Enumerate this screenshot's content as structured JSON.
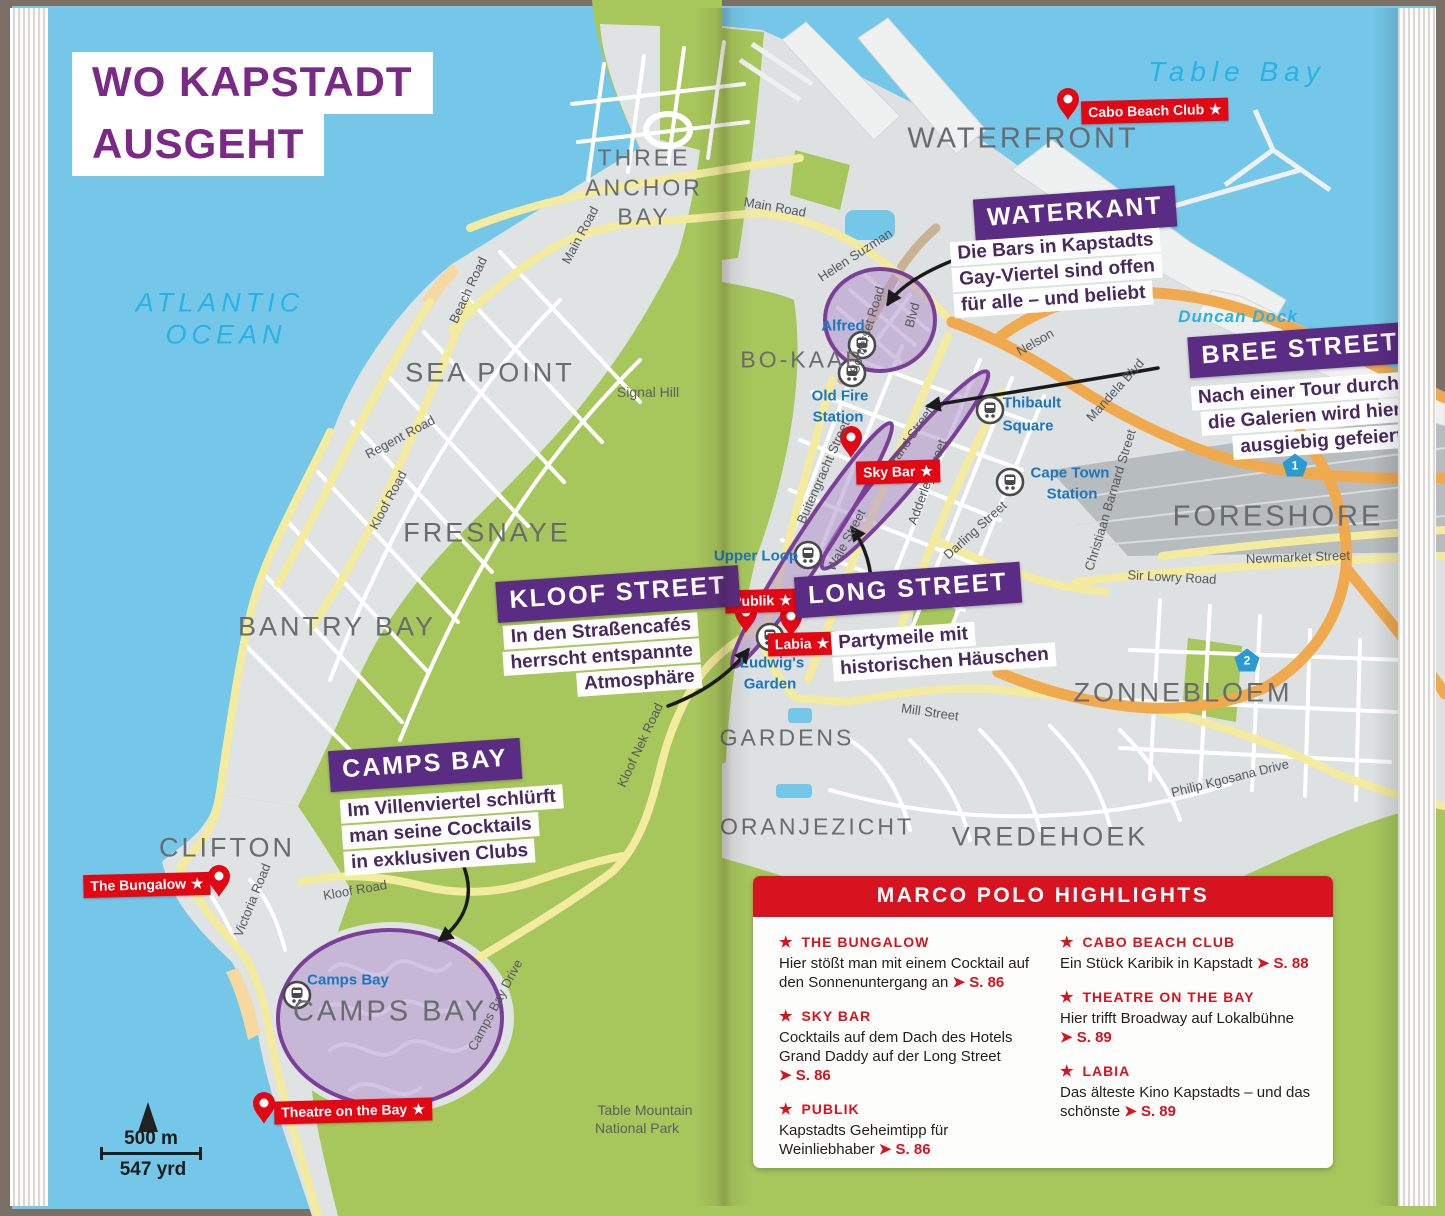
{
  "title": {
    "line1": "WO KAPSTADT",
    "line2": "AUSGEHT"
  },
  "water": {
    "ocean1": "ATLANTIC",
    "ocean2": "OCEAN",
    "table_bay": "Table Bay",
    "duncan_dock": "Duncan Dock"
  },
  "districts": {
    "waterfront": "WATERFRONT",
    "three1": "THREE",
    "three2": "ANCHOR",
    "three3": "BAY",
    "sea_point": "SEA POINT",
    "fresnaye": "FRESNAYE",
    "bantry_bay": "BANTRY BAY",
    "clifton": "CLIFTON",
    "bo_kaap": "BO-KAAP",
    "gardens": "GARDENS",
    "oranjezicht": "ORANJEZICHT",
    "vredehoek": "VREDEHOEK",
    "zonnebloem": "ZONNEBLOEM",
    "foreshore": "FORESHORE",
    "camps_bay": "CAMPS BAY"
  },
  "terrain": {
    "signal_hill": "Signal Hill",
    "tmnp1": "Table Mountain",
    "tmnp2": "National Park"
  },
  "streets": {
    "beach_road": "Beach Road",
    "main_road_w": "Main Road",
    "main_road_c": "Main Road",
    "helen_suzman": "Helen Suzman",
    "blvd": "Blvd",
    "somerset_road": "Somerset Road",
    "regent_road": "Regent Road",
    "kloof_road_w": "Kloof Road",
    "kloof_road_s": "Kloof Road",
    "victoria_road": "Victoria Road",
    "camps_bay_drive": "Camps Bay Drive",
    "kloof_nek_road": "Kloof Nek Road",
    "mill_street": "Mill Street",
    "philip_kgosana": "Philip Kgosana Drive",
    "sir_lowry": "Sir Lowry Road",
    "newmarket": "Newmarket Street",
    "christiaan_barnard": "Christiaan Barnard Street",
    "nelson": "Nelson",
    "mandela_blvd": "Mandela Blvd",
    "buitengracht": "Buitengracht Street",
    "strand": "Strand Street",
    "wale": "Wale Street",
    "adderley": "Adderley Street",
    "darling": "Darling Street"
  },
  "stations": {
    "alfred": "Alfred",
    "old_fire1": "Old Fire",
    "old_fire2": "Station",
    "thibault1": "Thibault",
    "thibault2": "Square",
    "cape_town1": "Cape Town",
    "cape_town2": "Station",
    "upper_loop": "Upper Loop",
    "ludwigs1": "Ludwig's",
    "ludwigs2": "Garden",
    "camps_bay": "Camps Bay"
  },
  "venues": {
    "cabo": "Cabo Beach Club",
    "sky_bar": "Sky Bar",
    "publik": "Publik",
    "labia": "Labia",
    "bungalow": "The Bungalow",
    "theatre": "Theatre on the Bay"
  },
  "callouts": {
    "waterkant": {
      "title": "WATERKANT",
      "lines": [
        "Die Bars in Kapstadts",
        "Gay-Viertel sind offen",
        "für alle – und beliebt"
      ]
    },
    "bree": {
      "title": "BREE STREET",
      "lines": [
        "Nach einer Tour durch",
        "die Galerien wird hier",
        "ausgiebig gefeiert"
      ]
    },
    "kloof": {
      "title": "KLOOF STREET",
      "lines": [
        "In den Straßencafés",
        "herrscht entspannte",
        "Atmosphäre"
      ]
    },
    "long": {
      "title": "LONG STREET",
      "lines": [
        "Partymeile mit",
        "historischen Häuschen"
      ]
    },
    "camps": {
      "title": "CAMPS BAY",
      "lines": [
        "Im Villenviertel schlürft",
        "man seine Cocktails",
        "in exklusiven Clubs"
      ]
    }
  },
  "highlights": {
    "header": "MARCO POLO HIGHLIGHTS",
    "entries": [
      {
        "name": "THE BUNGALOW",
        "desc": "Hier stößt man mit einem Cocktail auf den Sonnenuntergang an",
        "page": "S. 86"
      },
      {
        "name": "SKY BAR",
        "desc": "Cocktails auf dem Dach des Hotels Grand Daddy auf der Long Street",
        "page": "S. 86"
      },
      {
        "name": "PUBLIK",
        "desc": "Kapstadts Geheimtipp für Weinliebhaber",
        "page": "S. 86"
      },
      {
        "name": "CABO BEACH CLUB",
        "desc": "Ein Stück Karibik in Kapstadt",
        "page": "S. 88"
      },
      {
        "name": "THEATRE ON THE BAY",
        "desc": "Hier trifft Broadway auf Lokalbühne",
        "page": "S. 89"
      },
      {
        "name": "LABIA",
        "desc": "Das älteste Kino Kapstadts – und das schönste",
        "page": "S. 89"
      }
    ]
  },
  "scale": {
    "metric": "500 m",
    "imperial": "547 yrd"
  },
  "shields": {
    "n1": "1",
    "n2": "2"
  },
  "glyphs": {
    "star": "★",
    "arrow": "➤"
  },
  "colors": {
    "badge_red": "#e30613",
    "banner_purple": "#5b2c83",
    "highlight_red": "#d6131f",
    "station_blue": "#1b76bd",
    "water_cyan": "#29b2e3",
    "highlight_purple": "#7c3f98"
  }
}
